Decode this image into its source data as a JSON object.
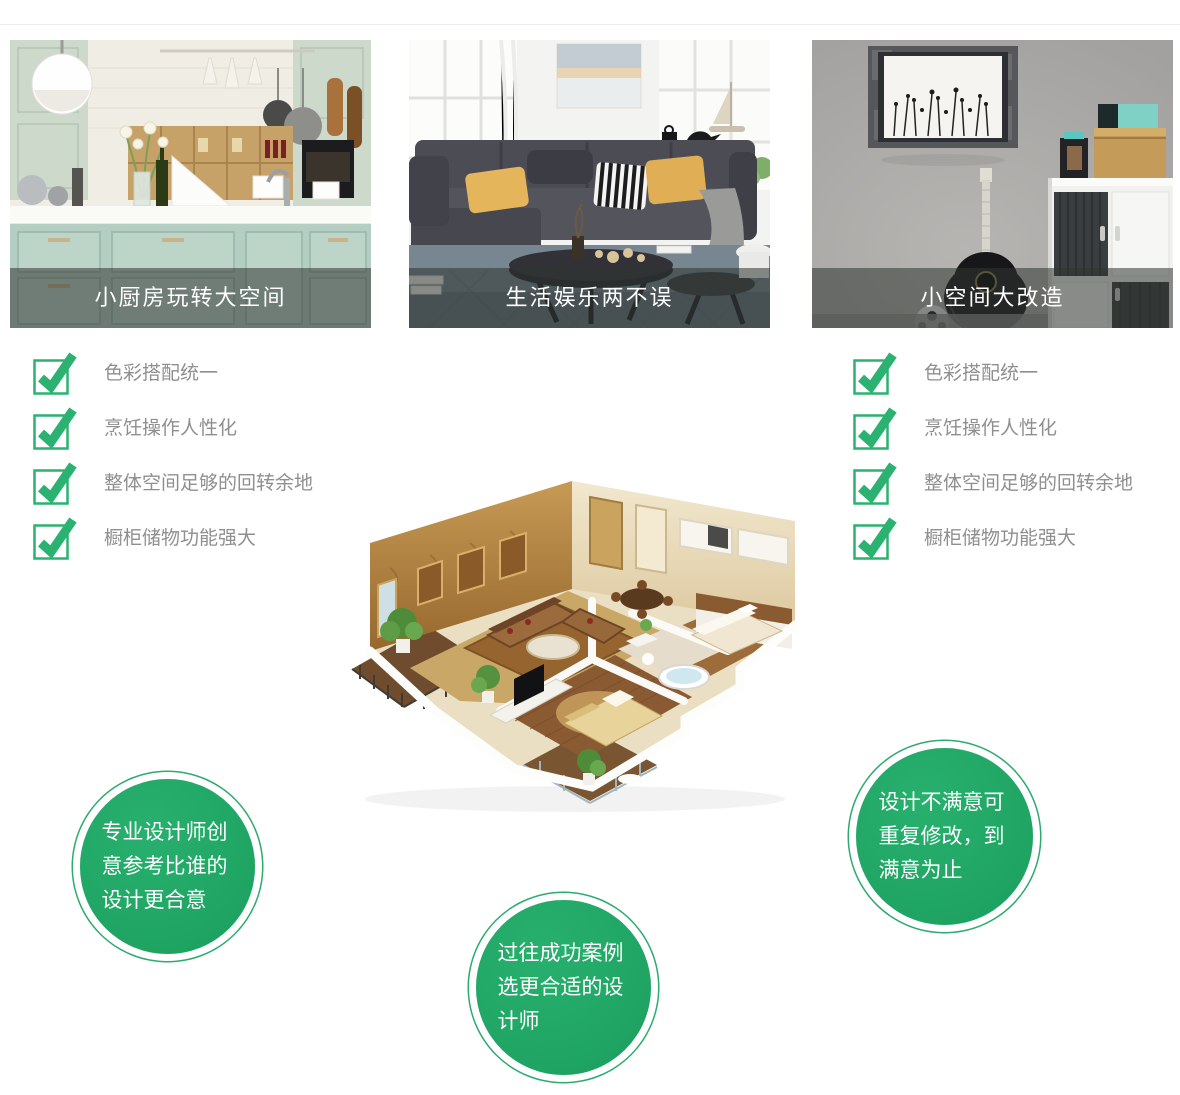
{
  "cards": [
    {
      "caption": "小厨房玩转大空间",
      "scene": "kitchen-photo"
    },
    {
      "caption": "生活娱乐两不误",
      "scene": "living-room-photo"
    },
    {
      "caption": "小空间大改造",
      "scene": "small-space-photo"
    }
  ],
  "checklist": {
    "items": [
      "色彩搭配统一",
      "烹饪操作人性化",
      "整体空间足够的回转余地",
      "橱柜储物功能强大"
    ]
  },
  "bubbles": [
    {
      "text": "专业设计师创意参考比谁的设计更合意"
    },
    {
      "text": "过往成功案例选更合适的设计师"
    },
    {
      "text": "设计不满意可重复修改，到满意为止"
    }
  ],
  "icons": {
    "check": "checked-checkbox-icon",
    "floorplan": "isometric-3d-apartment-rendering"
  },
  "colors": {
    "check_green": "#2bb271",
    "bubble_green": "#21a765",
    "list_text_gray": "#8f8f8f",
    "caption_overlay": "rgba(47,52,50,0.55)",
    "caption_text": "#ffffff"
  }
}
